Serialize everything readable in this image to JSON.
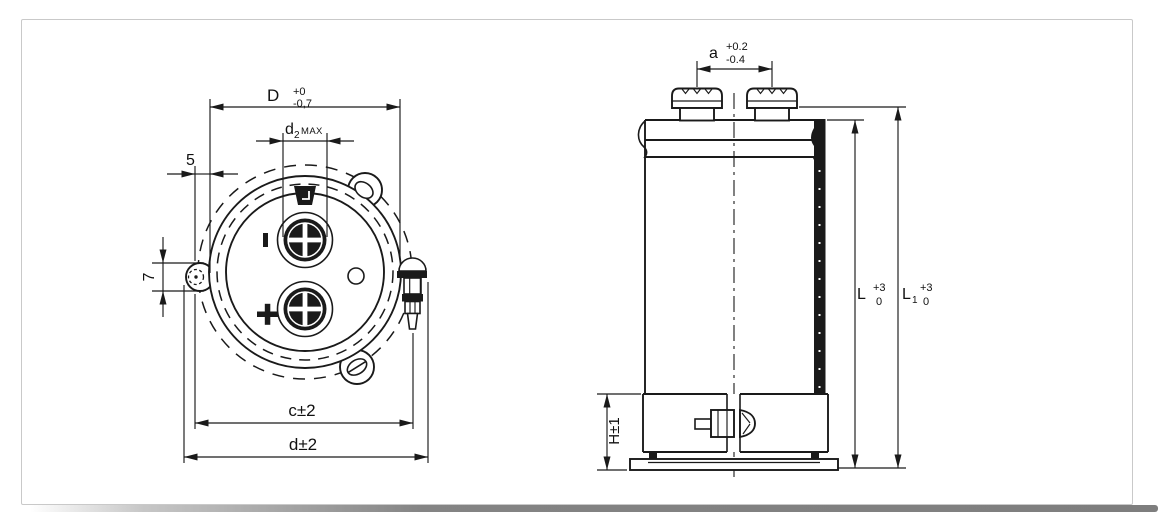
{
  "page": {
    "background": "#ffffff",
    "panel_border_color": "#c9c9c9",
    "line_color": "#1a1a1a"
  },
  "top_view": {
    "dim_D": {
      "symbol": "D",
      "tol_upper": "+0",
      "tol_lower": "-0,7"
    },
    "dim_d2": {
      "symbol": "d",
      "subscript": "2",
      "qualifier": "MAX"
    },
    "dim_flat_offset": "5",
    "dim_lug_hole": "7",
    "dim_c": "c±2",
    "dim_d": "d±2",
    "polarity_minus": "−",
    "polarity_plus": "+"
  },
  "side_view": {
    "dim_a": {
      "symbol": "a",
      "tol_upper": "+0.2",
      "tol_lower": "-0.4"
    },
    "dim_L": {
      "symbol": "L",
      "tol_upper": "+3",
      "tol_lower": "0"
    },
    "dim_L1": {
      "symbol": "L",
      "subscript": "1",
      "tol_upper": "+3",
      "tol_lower": "0"
    },
    "dim_H": "H±1"
  }
}
